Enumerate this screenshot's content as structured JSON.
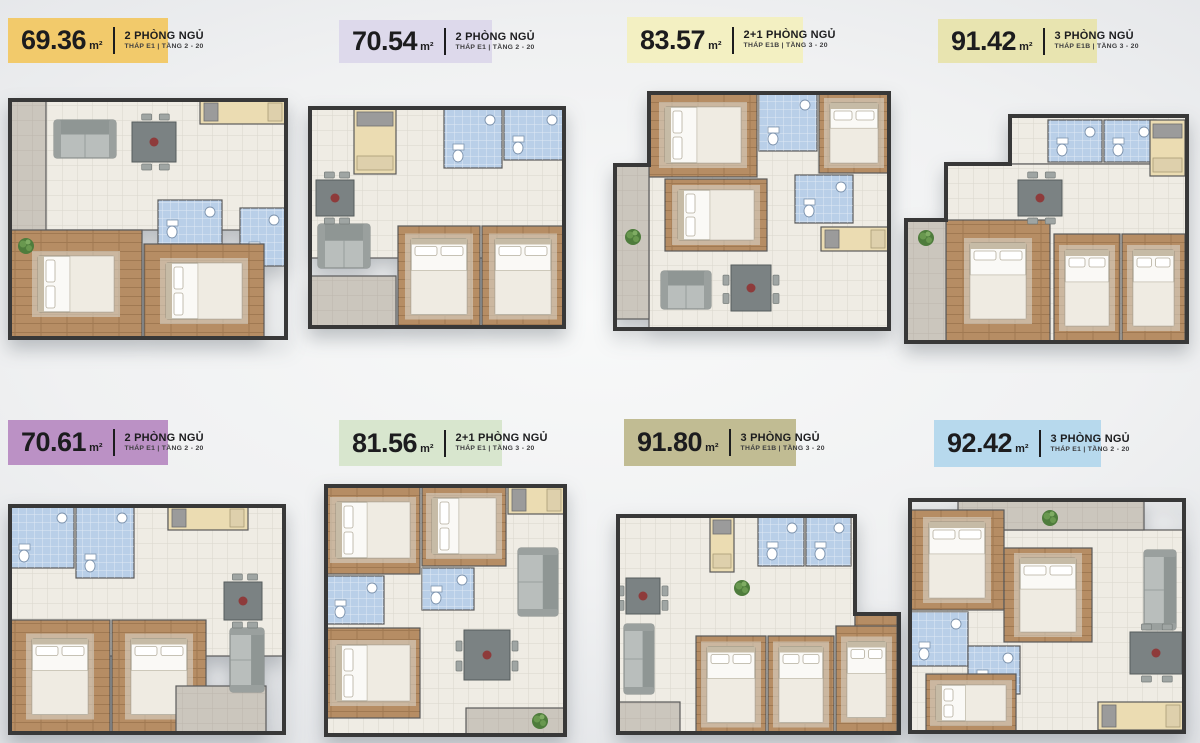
{
  "palette": {
    "wall": "#383838",
    "tile": "#EFECE4",
    "wood": "#B68D64",
    "bath": "#B9CFE8",
    "balcony": "#CBC6BD",
    "kitchen": "#EBDCB2",
    "bed": "#FAF9F6",
    "sofa": "#B9BEBC",
    "table": "#7B8283",
    "plant": "#55823F"
  },
  "units": [
    {
      "area": "69.36",
      "area_unit": "m²",
      "bedrooms": "2 PHÒNG NGỦ",
      "location": "THÁP E1 | TẦNG 2 - 20",
      "badge_color": "#F2CA6B",
      "floor_plan": {
        "outline": [
          8,
          10,
          276,
          238
        ],
        "rooms": [
          {
            "t": "tile",
            "r": [
              8,
              10,
              276,
              130
            ]
          },
          {
            "t": "kitchen",
            "r": [
              198,
              10,
              86,
              24
            ]
          },
          {
            "t": "balcony",
            "r": [
              8,
              10,
              36,
              168
            ]
          },
          {
            "t": "bath",
            "r": [
              156,
              110,
              64,
              44
            ]
          },
          {
            "t": "bath",
            "r": [
              238,
              118,
              46,
              58
            ]
          },
          {
            "t": "wood",
            "r": [
              8,
              140,
              132,
              108
            ]
          },
          {
            "t": "wood",
            "r": [
              142,
              154,
              120,
              94
            ]
          }
        ],
        "sofa": [
          52,
          30,
          62,
          38
        ],
        "table": [
          130,
          32,
          44,
          40
        ],
        "plants": [
          [
            24,
            156
          ]
        ]
      }
    },
    {
      "area": "70.54",
      "area_unit": "m²",
      "bedrooms": "2 PHÒNG NGỦ",
      "location": "THÁP E1 | TẦNG 2 - 20",
      "badge_color": "#DDD9EB",
      "floor_plan": {
        "outline": [
          8,
          8,
          254,
          219
        ],
        "rooms": [
          {
            "t": "tile",
            "r": [
              8,
              8,
              254,
              150
            ]
          },
          {
            "t": "kitchen",
            "r": [
              52,
              8,
              42,
              66
            ]
          },
          {
            "t": "bath",
            "r": [
              142,
              8,
              58,
              60
            ]
          },
          {
            "t": "bath",
            "r": [
              202,
              8,
              60,
              52
            ]
          },
          {
            "t": "wood",
            "r": [
              96,
              126,
              82,
              101
            ]
          },
          {
            "t": "wood",
            "r": [
              180,
              126,
              82,
              101
            ]
          },
          {
            "t": "balcony",
            "r": [
              8,
              176,
              86,
              51
            ]
          }
        ],
        "sofa": [
          16,
          124,
          52,
          44
        ],
        "table": [
          14,
          80,
          38,
          36
        ],
        "plants": []
      }
    },
    {
      "area": "83.57",
      "area_unit": "m²",
      "bedrooms": "2+1 PHÒNG NGỦ",
      "location": "THÁP E1B | TẦNG 3 - 20",
      "badge_color": "#F3F0C2",
      "floor_plan": {
        "outline": [
          8,
          8,
          274,
          236
        ],
        "outline_points": "42,8 282,8 282,244 8,244 8,80 42,80",
        "rooms": [
          {
            "t": "tile",
            "r": [
              42,
              8,
              240,
              236
            ]
          },
          {
            "t": "wood",
            "r": [
              42,
              8,
              108,
              84
            ]
          },
          {
            "t": "bath",
            "r": [
              152,
              8,
              58,
              58
            ]
          },
          {
            "t": "wood",
            "r": [
              212,
              8,
              70,
              80
            ]
          },
          {
            "t": "wood",
            "r": [
              58,
              94,
              102,
              72
            ]
          },
          {
            "t": "bath",
            "r": [
              188,
              90,
              58,
              48
            ]
          },
          {
            "t": "balcony",
            "r": [
              8,
              80,
              34,
              154
            ]
          },
          {
            "t": "kitchen",
            "r": [
              214,
              142,
              68,
              24
            ]
          }
        ],
        "sofa": [
          54,
          186,
          50,
          38
        ],
        "table": [
          124,
          180,
          40,
          46
        ],
        "plants": [
          [
            26,
            152
          ]
        ]
      }
    },
    {
      "area": "91.42",
      "area_unit": "m²",
      "bedrooms": "3 PHÒNG NGỦ",
      "location": "THÁP E1B | TẦNG 3 - 20",
      "badge_color": "#E8E4B0",
      "floor_plan": {
        "outline": [
          8,
          8,
          281,
          226
        ],
        "outline_points": "112,8 289,8 289,234 8,234 8,112 48,112 48,56 112,56",
        "rooms": [
          {
            "t": "tile",
            "r": [
              112,
              8,
              177,
              48
            ]
          },
          {
            "t": "tile",
            "r": [
              48,
              56,
              241,
              178
            ]
          },
          {
            "t": "bath",
            "r": [
              150,
              12,
              54,
              42
            ]
          },
          {
            "t": "bath",
            "r": [
              206,
              12,
              52,
              42
            ]
          },
          {
            "t": "kitchen",
            "r": [
              252,
              12,
              35,
              56
            ]
          },
          {
            "t": "wood",
            "r": [
              48,
              112,
              104,
              122
            ]
          },
          {
            "t": "wood",
            "r": [
              156,
              126,
              66,
              108
            ]
          },
          {
            "t": "wood",
            "r": [
              224,
              126,
              63,
              108
            ]
          },
          {
            "t": "balcony",
            "r": [
              8,
              112,
              40,
              122
            ]
          }
        ],
        "sofa": null,
        "table": [
          120,
          72,
          44,
          36
        ],
        "plants": [
          [
            28,
            130
          ]
        ]
      }
    },
    {
      "area": "70.61",
      "area_unit": "m²",
      "bedrooms": "2 PHÒNG NGỦ",
      "location": "THÁP E1 | TẦNG 2 - 20",
      "badge_color": "#BB91C5",
      "floor_plan": {
        "outline": [
          8,
          8,
          274,
          227
        ],
        "rooms": [
          {
            "t": "tile",
            "r": [
              8,
              8,
              274,
              150
            ]
          },
          {
            "t": "bath",
            "r": [
              8,
              8,
              64,
              62
            ]
          },
          {
            "t": "bath",
            "r": [
              74,
              8,
              58,
              72
            ]
          },
          {
            "t": "kitchen",
            "r": [
              166,
              8,
              80,
              24
            ]
          },
          {
            "t": "wood",
            "r": [
              8,
              122,
              100,
              113
            ]
          },
          {
            "t": "wood",
            "r": [
              110,
              122,
              94,
              113
            ]
          },
          {
            "t": "balcony",
            "r": [
              174,
              188,
              90,
              47
            ]
          }
        ],
        "sofa": [
          228,
          130,
          34,
          64
        ],
        "table": [
          222,
          84,
          38,
          38
        ],
        "plants": []
      }
    },
    {
      "area": "81.56",
      "area_unit": "m²",
      "bedrooms": "2+1 PHÒNG NGỦ",
      "location": "THÁP E1 | TẦNG 3 - 20",
      "badge_color": "#D8E6CE",
      "floor_plan": {
        "outline": [
          8,
          8,
          239,
          249
        ],
        "rooms": [
          {
            "t": "tile",
            "r": [
              8,
              8,
              239,
              249
            ]
          },
          {
            "t": "wood",
            "r": [
              8,
              8,
              94,
              88
            ]
          },
          {
            "t": "wood",
            "r": [
              104,
              8,
              84,
              80
            ]
          },
          {
            "t": "bath",
            "r": [
              8,
              98,
              58,
              48
            ]
          },
          {
            "t": "bath",
            "r": [
              104,
              90,
              52,
              42
            ]
          },
          {
            "t": "wood",
            "r": [
              8,
              150,
              94,
              90
            ]
          },
          {
            "t": "kitchen",
            "r": [
              190,
              8,
              57,
              28
            ]
          },
          {
            "t": "balcony",
            "r": [
              148,
              230,
              99,
              27
            ]
          }
        ],
        "sofa": [
          200,
          70,
          40,
          68
        ],
        "table": [
          146,
          152,
          46,
          50
        ],
        "plants": [
          [
            222,
            243
          ]
        ]
      }
    },
    {
      "area": "91.80",
      "area_unit": "m²",
      "bedrooms": "3 PHÒNG NGỦ",
      "location": "THÁP E1B | TẦNG 3 - 20",
      "badge_color": "#C1BC93",
      "floor_plan": {
        "outline": [
          8,
          8,
          281,
          217
        ],
        "outline_points": "8,8 245,8 245,106 289,106 289,225 8,225",
        "rooms": [
          {
            "t": "tile",
            "r": [
              8,
              8,
              237,
              217
            ]
          },
          {
            "t": "woodplain",
            "r": [
              245,
              106,
              42,
              119
            ]
          },
          {
            "t": "kitchen",
            "r": [
              100,
              8,
              24,
              56
            ]
          },
          {
            "t": "bath",
            "r": [
              148,
              8,
              46,
              50
            ]
          },
          {
            "t": "bath",
            "r": [
              196,
              8,
              45,
              50
            ]
          },
          {
            "t": "wood",
            "r": [
              86,
              128,
              70,
              97
            ]
          },
          {
            "t": "wood",
            "r": [
              158,
              128,
              66,
              97
            ]
          },
          {
            "t": "wood",
            "r": [
              226,
              118,
              61,
              107
            ]
          },
          {
            "t": "balcony",
            "r": [
              8,
              194,
              62,
              31
            ]
          }
        ],
        "sofa": [
          14,
          116,
          30,
          70
        ],
        "table": [
          16,
          70,
          34,
          36
        ],
        "plants": [
          [
            132,
            80
          ]
        ]
      }
    },
    {
      "area": "92.42",
      "area_unit": "m²",
      "bedrooms": "3 PHÒNG NGỦ",
      "location": "THÁP E1 | TẦNG 2 - 20",
      "badge_color": "#B7D9ED",
      "floor_plan": {
        "outline": [
          8,
          8,
          274,
          232
        ],
        "rooms": [
          {
            "t": "tile",
            "r": [
              8,
              38,
              274,
              202
            ]
          },
          {
            "t": "balcony",
            "r": [
              56,
              8,
              186,
              30
            ]
          },
          {
            "t": "wood",
            "r": [
              8,
              18,
              94,
              100
            ]
          },
          {
            "t": "wood",
            "r": [
              102,
              56,
              88,
              94
            ]
          },
          {
            "t": "bath",
            "r": [
              8,
              120,
              58,
              54
            ]
          },
          {
            "t": "bath",
            "r": [
              66,
              154,
              52,
              48
            ]
          },
          {
            "t": "wood",
            "r": [
              24,
              182,
              90,
              58
            ]
          },
          {
            "t": "kitchen",
            "r": [
              196,
              210,
              86,
              28
            ]
          }
        ],
        "sofa": [
          242,
          58,
          32,
          80
        ],
        "table": [
          228,
          140,
          52,
          42
        ],
        "plants": [
          [
            148,
            26
          ]
        ]
      }
    }
  ]
}
